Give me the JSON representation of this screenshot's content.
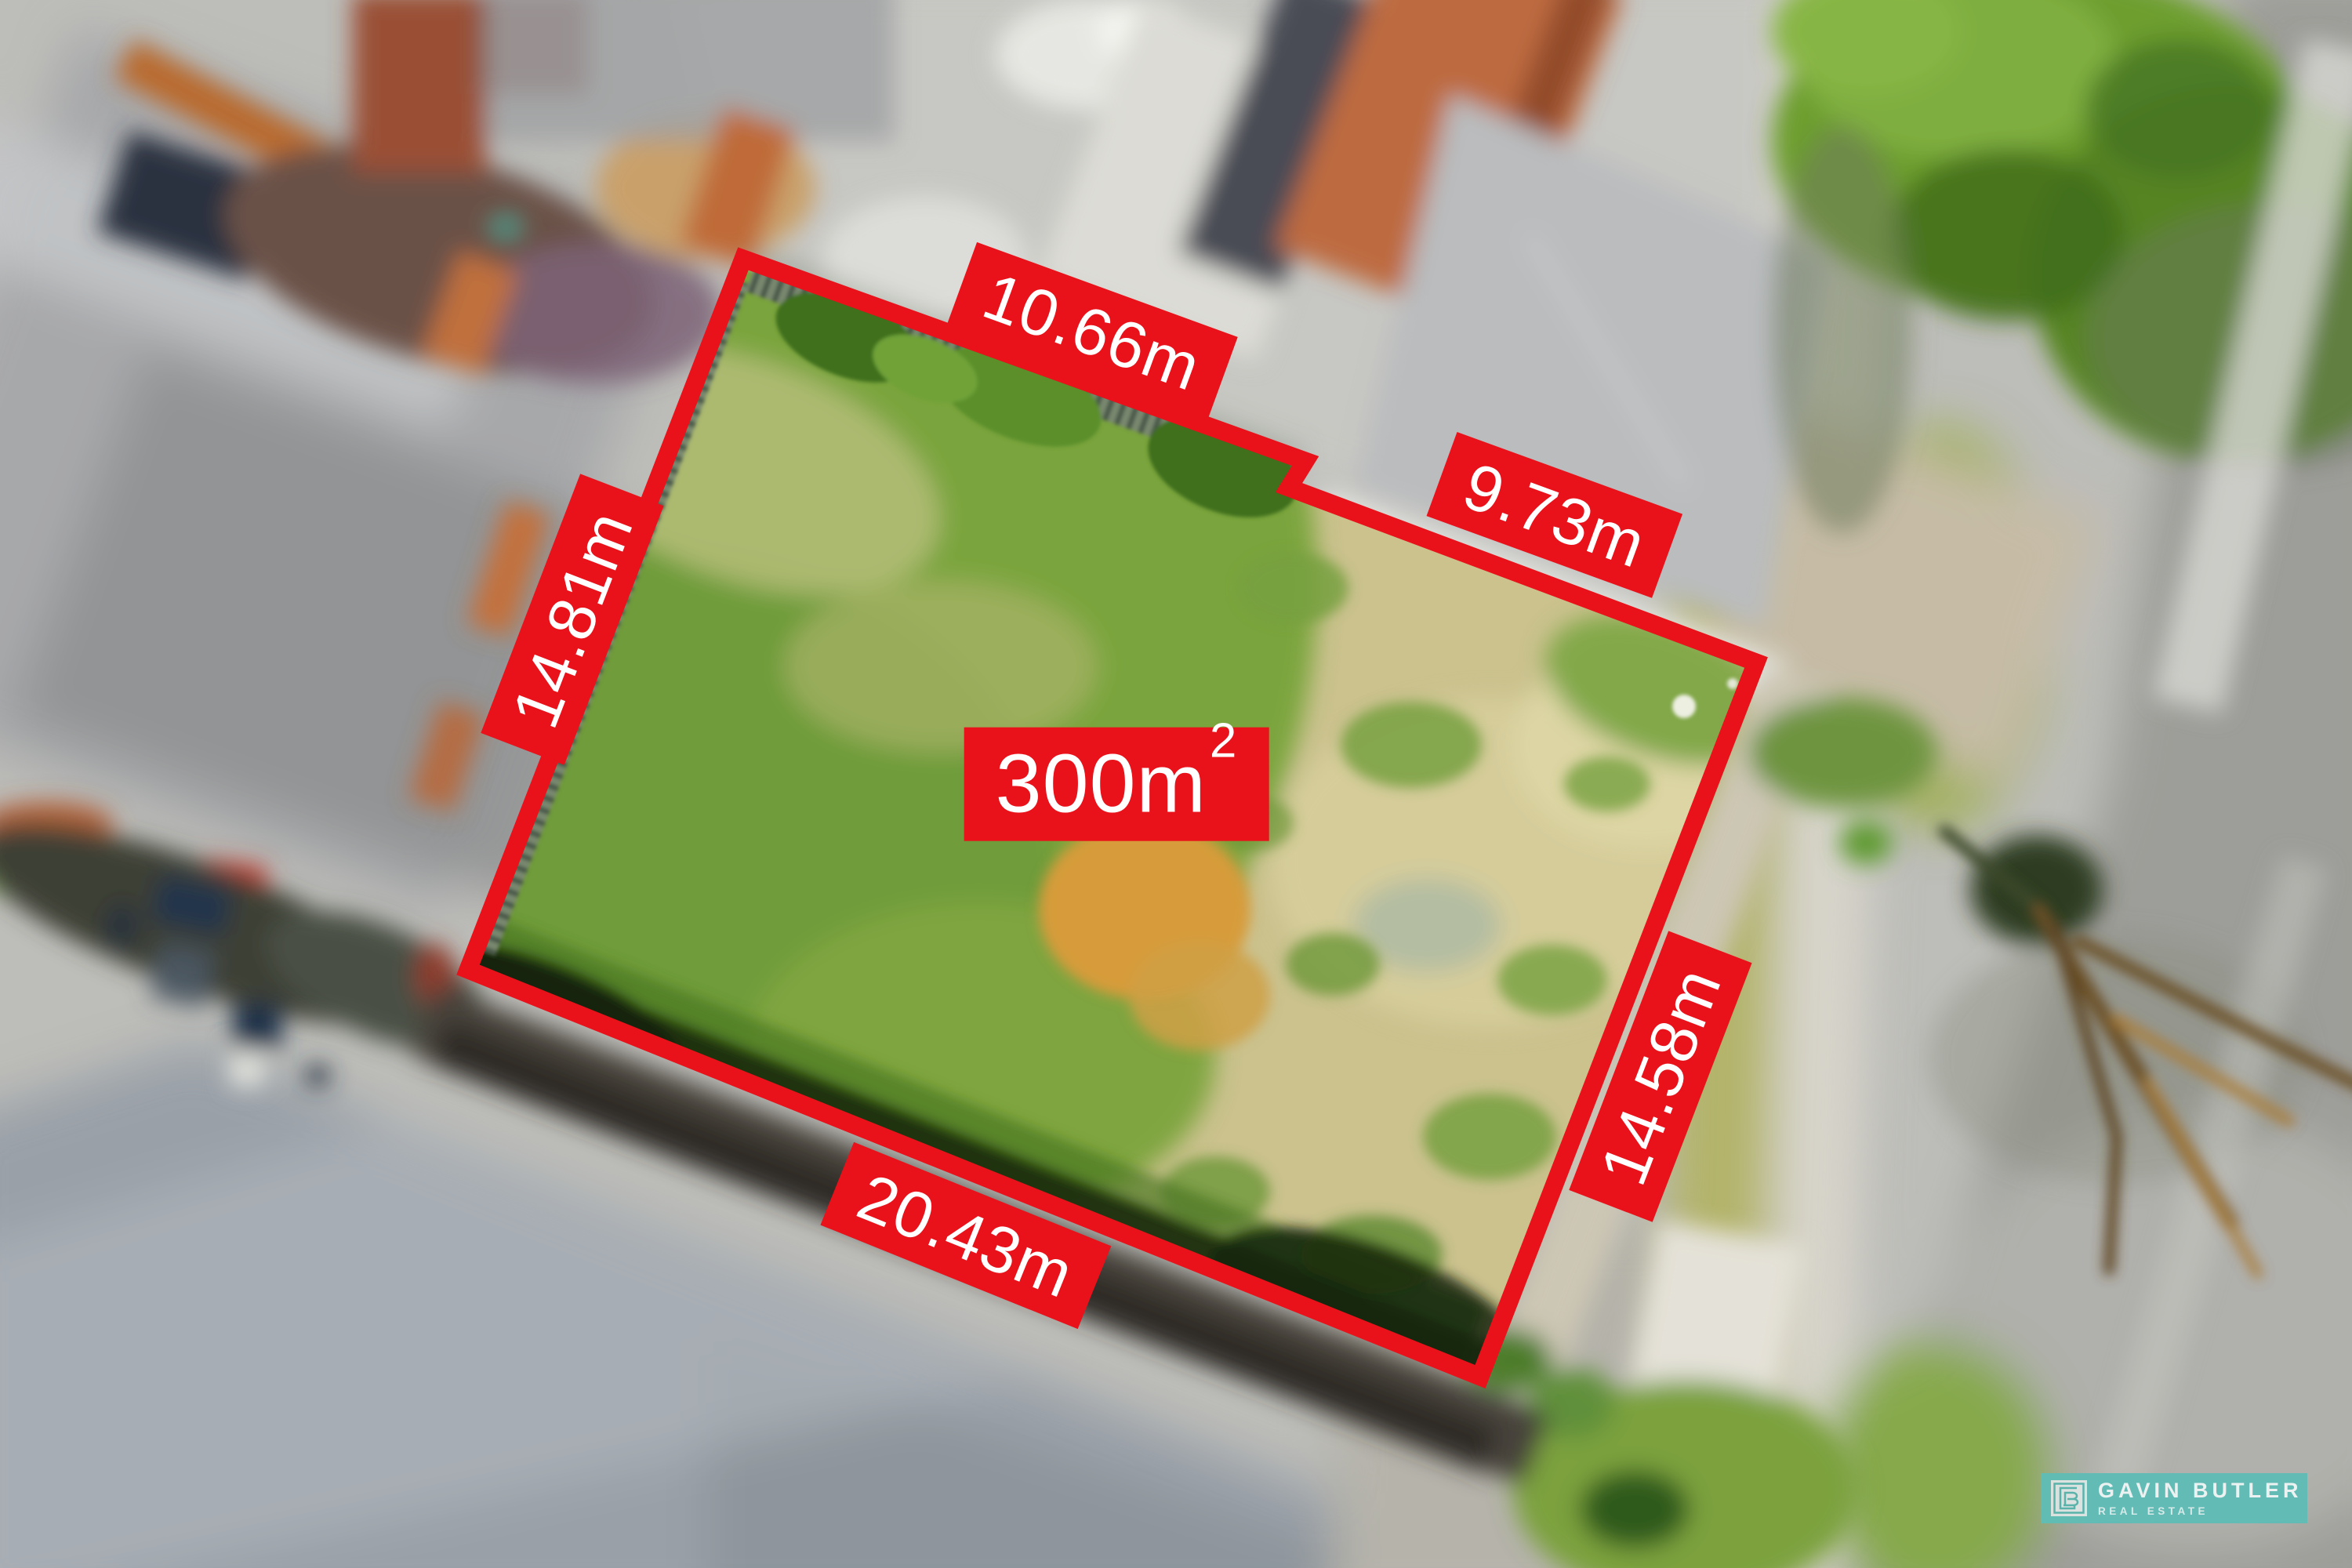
{
  "lot": {
    "area": {
      "value": "300m",
      "superscript": "2"
    },
    "dimensions": {
      "top": "10.66m",
      "upper_right": "9.73m",
      "left": "14.81m",
      "right": "14.58m",
      "bottom": "20.43m"
    }
  },
  "branding": {
    "name": "GAVIN BUTLER",
    "tagline": "REAL ESTATE"
  },
  "colors": {
    "annotation_red": "#e9121b",
    "brand_teal": "#5fbdb6",
    "label_text": "#ffffff"
  }
}
